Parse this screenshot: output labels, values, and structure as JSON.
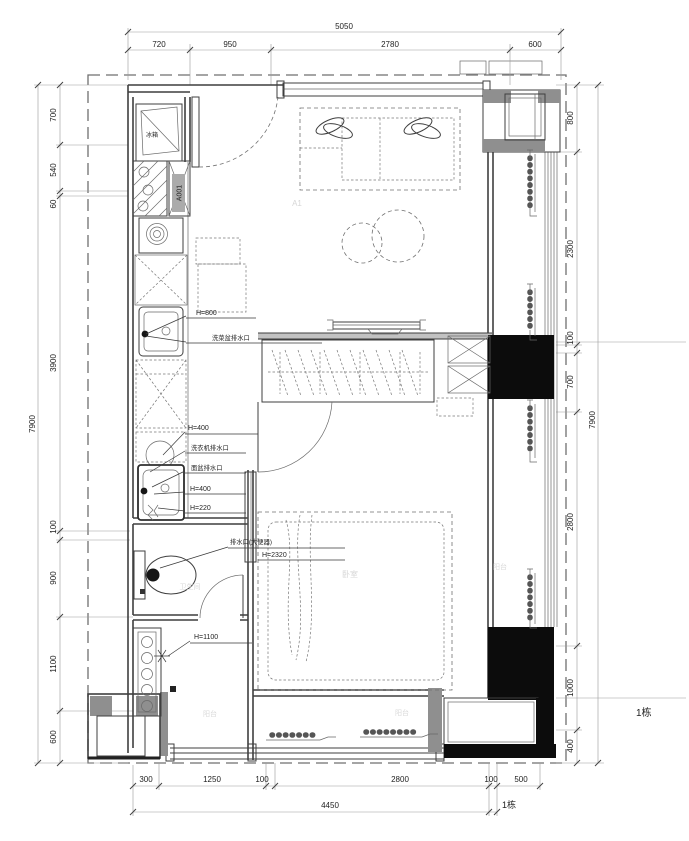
{
  "colors": {
    "wall_line": "#3f3f3f",
    "black_fill": "#0c0c0c",
    "gray_fill": "#8f8f8f",
    "light_gray": "#c2c2c2",
    "dim_line": "#9a9a9a",
    "text": "#1f1f1f",
    "watermark": "#d6d6d6"
  },
  "dimensions": {
    "top": {
      "total": "5050",
      "segments": [
        "720",
        "950",
        "2780",
        "600"
      ]
    },
    "left": {
      "total": "7900",
      "segments": [
        "700",
        "540",
        "60",
        "3900",
        "100",
        "900",
        "1100",
        "600"
      ]
    },
    "right": {
      "total": "7900",
      "segments": [
        "800",
        "2300",
        "100",
        "700",
        "2800",
        "1000",
        "400"
      ]
    },
    "bottom": {
      "total": "4450",
      "segments": [
        "300",
        "1250",
        "100",
        "2800",
        "100",
        "500"
      ]
    }
  },
  "labels": {
    "door_tag": "A001",
    "building": "1栋",
    "sink_height": "H=800",
    "sink_drain": "洗菜盆排水口",
    "washer_height": "H=400",
    "washer_drain": "洗衣机排水口",
    "basin_drain": "面盆排水口",
    "basin_height": "H=400",
    "floor_drain_height": "H=220",
    "toilet_drain": "排水口(大便器)",
    "toilet_height": "H=2320",
    "switch_height": "H=1100"
  },
  "room_watermarks": {
    "unit": "A1",
    "bedroom": "卧室",
    "bathroom": "卫生间",
    "balcony": "阳台",
    "fridge": "冰箱"
  }
}
